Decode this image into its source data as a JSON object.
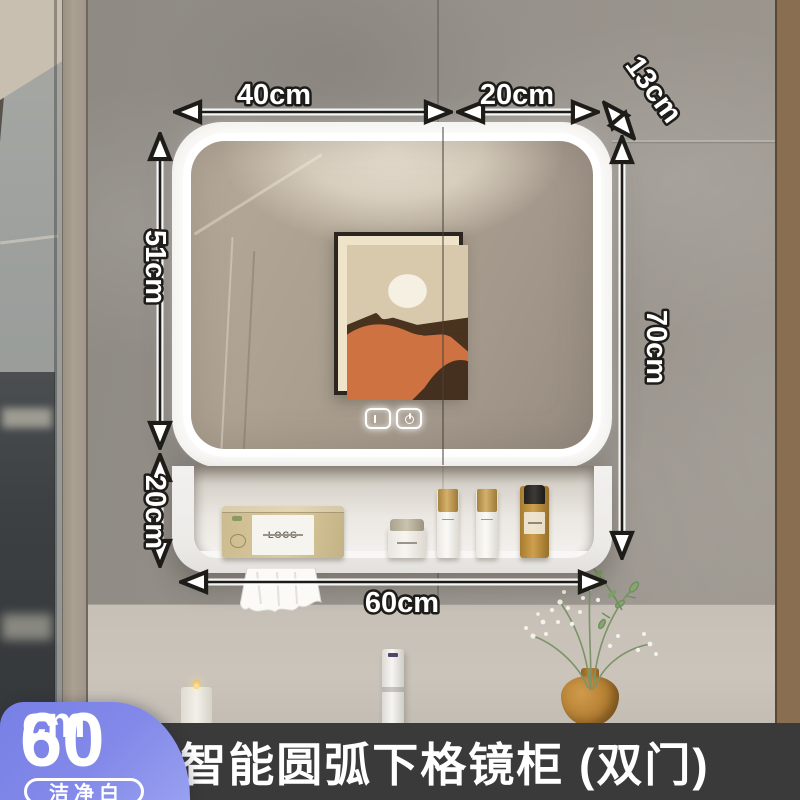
{
  "product": {
    "title": "智能圆弧下格镜柜 (双门)",
    "badge": {
      "size_value": "60",
      "size_unit": "cm",
      "finish_label": "洁净白"
    }
  },
  "dimensions": {
    "top_left_door_width": "40cm",
    "top_right_door_width": "20cm",
    "depth": "13cm",
    "mirror_height": "51cm",
    "shelf_height": "20cm",
    "total_height": "70cm",
    "total_width": "60cm"
  },
  "icons": {
    "defog": "defog-touch-icon",
    "power": "power-touch-icon"
  },
  "colors": {
    "badge_accent": "#7E87E8",
    "title_bar": "#3A3A3A",
    "led_light": "#FFFFFF",
    "cabinet_white": "#F3F2EF"
  }
}
